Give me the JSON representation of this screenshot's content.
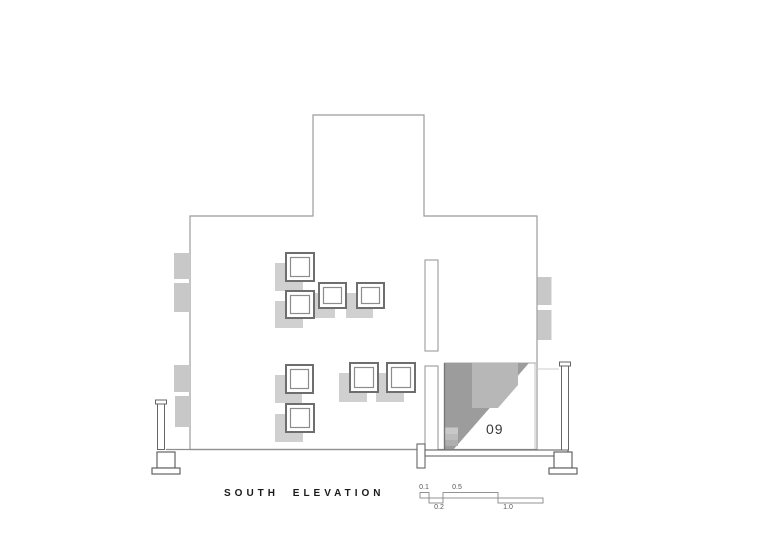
{
  "sheet": {
    "title": "SOUTH ELEVATION",
    "room_label": "09"
  },
  "scale_bar": {
    "labels": [
      {
        "text": "0.1",
        "row": "top"
      },
      {
        "text": "0.5",
        "row": "top"
      },
      {
        "text": "0.2",
        "row": "bottom"
      },
      {
        "text": "1.0",
        "row": "bottom"
      }
    ]
  },
  "colors": {
    "background": "#ffffff",
    "outline": "#9b9b9b",
    "window_frame": "#6e6e6e",
    "window_shadow": "#d0d0d0",
    "side_block": "#c8c8c8",
    "shade_dark": "#9c9c9c",
    "shade_mid": "#b7b7b7",
    "title_text": "#1a1a1a",
    "label_text": "#3a3a3a"
  }
}
